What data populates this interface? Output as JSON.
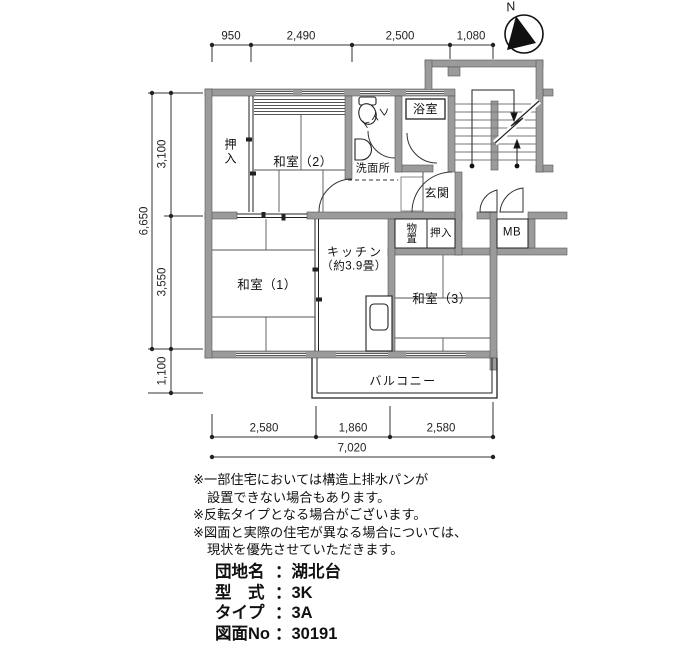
{
  "compass": {
    "north_label": "N"
  },
  "dimensions": {
    "top": [
      "950",
      "2,490",
      "2,500",
      "1,080"
    ],
    "left_total": "6,650",
    "left_segments": [
      "3,100",
      "3,550",
      "1,100"
    ],
    "bottom_segments": [
      "2,580",
      "1,860",
      "2,580"
    ],
    "bottom_total": "7,020"
  },
  "rooms": {
    "closet_left": "押入",
    "japanese_room_2": "和室（2）",
    "toilet": "トイレ",
    "washroom": "洗面所",
    "bathroom": "浴室",
    "entrance": "玄関",
    "storage": "物置",
    "closet_middle": "押入",
    "meter_box": "MB",
    "kitchen_name": "キッチン",
    "kitchen_size": "（約3.9畳）",
    "japanese_room_1": "和室（1）",
    "japanese_room_3": "和室（3）",
    "balcony": "バルコニー"
  },
  "notes": {
    "lines": [
      "※一部住宅においては構造上排水パンが",
      "設置できない場合もあります。",
      "※反転タイプとなる場合がございます。",
      "※図面と実際の住宅が異なる場合については、",
      "現状を優先させていただきます。"
    ]
  },
  "info": {
    "separator": "：",
    "rows": [
      {
        "label": "団地名",
        "value": "湖北台"
      },
      {
        "label": "型　式",
        "value": "3K"
      },
      {
        "label": "タイプ",
        "value": "3A"
      },
      {
        "label": "図面No",
        "value": "30191"
      }
    ]
  },
  "colors": {
    "wall": "#9b9b9b",
    "line": "#1a1a1a"
  }
}
